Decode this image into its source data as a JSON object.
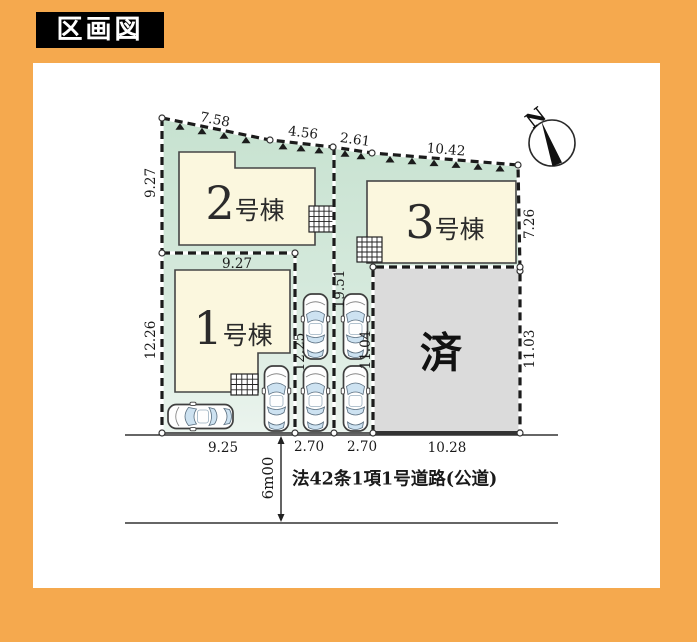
{
  "title": "区画図",
  "compass": {
    "north_label": "N"
  },
  "buildings": {
    "b1": {
      "num": "1",
      "suffix": "号棟"
    },
    "b2": {
      "num": "2",
      "suffix": "号棟"
    },
    "b3": {
      "num": "3",
      "suffix": "号棟"
    },
    "sold": {
      "label": "済"
    }
  },
  "dimensions": {
    "top_1": "7.58",
    "top_2": "4.56",
    "top_3": "2.61",
    "top_4": "10.42",
    "left_upper": "9.27",
    "left_lower": "12.26",
    "plot1_top": "9.27",
    "right_upper": "7.26",
    "right_lower": "11.03",
    "inner_left": "12.25",
    "inner_mid": "19.51",
    "inner_right": "11.04",
    "bottom_1": "9.25",
    "bottom_2": "2.70",
    "bottom_3": "2.70",
    "bottom_4": "10.28"
  },
  "road": {
    "width": "6m00",
    "name": "法42条1項1号道路(公道)"
  },
  "colors": {
    "frame": "#F5A94E",
    "land_green": "#CFE6D7",
    "building_cream": "#FBF7DE",
    "sold_gray": "#DBDBDB",
    "glass_blue": "#CDE2F1",
    "line_dark": "#1B1B1B"
  }
}
